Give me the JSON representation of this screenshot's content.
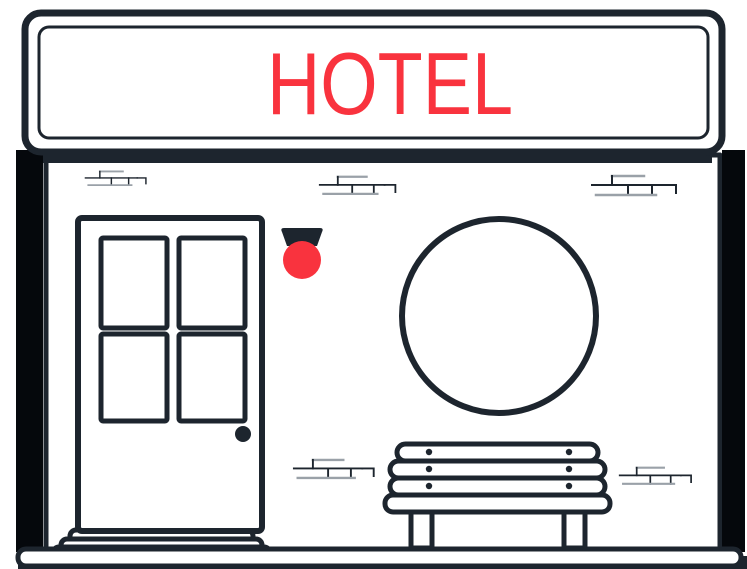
{
  "meta": {
    "description": "Flat line-art illustration of a hotel storefront facade",
    "canvas": {
      "width": 747,
      "height": 569
    }
  },
  "colors": {
    "ink": "#1d252e",
    "pillar": "#05080c",
    "accent": "#f9333e",
    "brick_gray": "#9aa1a8",
    "background": "#ffffff"
  },
  "sign": {
    "label": "HOTEL"
  },
  "scene": {
    "parts": [
      "signboard",
      "sign-base",
      "left-pillar",
      "right-pillar",
      "wall",
      "brick-details",
      "entrance-door",
      "door-window-panes",
      "door-knob",
      "door-steps",
      "wall-lamp",
      "round-window",
      "bench",
      "sidewalk",
      "ground"
    ]
  }
}
